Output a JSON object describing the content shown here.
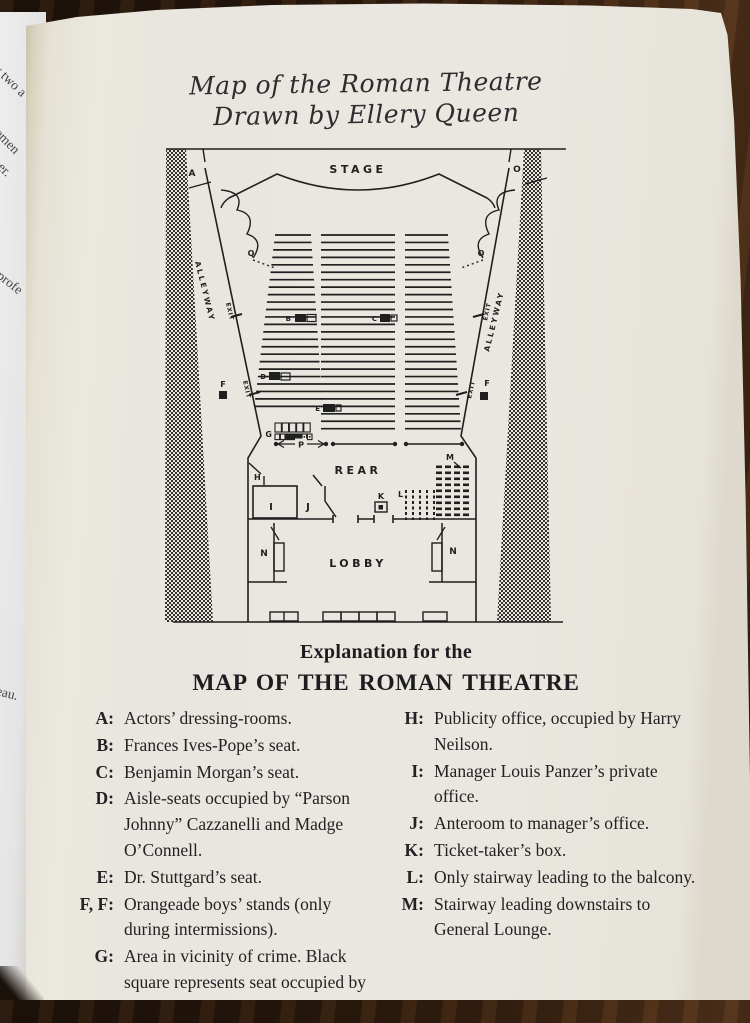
{
  "book_page": {
    "handwritten_title_line1": "Map of the Roman Theatre",
    "handwritten_title_line2": "Drawn by Ellery Queen",
    "explanation_heading": "Explanation for the",
    "explanation_title": "MAP OF THE ROMAN THEATRE"
  },
  "map": {
    "area_labels": {
      "stage": "STAGE",
      "rear": "REAR",
      "lobby": "LOBBY",
      "alleyway": "ALLEYWAY",
      "exit": "EXIT"
    },
    "point_labels": {
      "a": "A",
      "b": "B",
      "c": "C",
      "d": "D",
      "e": "E",
      "f": "F",
      "g": "G",
      "h": "H",
      "i": "I",
      "j": "J",
      "k": "K",
      "l": "L",
      "m": "M",
      "n": "N",
      "o": "O",
      "p": "P",
      "q": "Q"
    }
  },
  "legend": {
    "left": [
      {
        "key": "A:",
        "text": "Actors’ dressing-rooms."
      },
      {
        "key": "B:",
        "text": "Frances Ives-Pope’s seat."
      },
      {
        "key": "C:",
        "text": "Benjamin Morgan’s seat."
      },
      {
        "key": "D:",
        "text": "Aisle-seats occupied by “Parson Johnny” Cazzanelli and Madge O’Connell."
      },
      {
        "key": "E:",
        "text": "Dr. Stuttgard’s seat."
      },
      {
        "key": "F, F:",
        "text": "Orangeade boys’ stands (only during intermissions)."
      },
      {
        "key": "G:",
        "text": "Area in vicinity of crime. Black square represents seat occupied by Monte Field."
      }
    ],
    "right": [
      {
        "key": "H:",
        "text": "Publicity office, occupied by Harry Neilson."
      },
      {
        "key": "I:",
        "text": "Manager Louis Panzer’s private office."
      },
      {
        "key": "J:",
        "text": "Anteroom to manager’s office."
      },
      {
        "key": "K:",
        "text": "Ticket-taker’s box."
      },
      {
        "key": "L:",
        "text": "Only stairway leading to the balcony."
      },
      {
        "key": "M:",
        "text": "Stairway leading downstairs to General Lounge."
      }
    ]
  },
  "adjacent_page_fragments": [
    "or two a",
    "gentlemen",
    "iner.",
    "a profe",
    "reau."
  ],
  "colors": {
    "paper": "#e9e6df",
    "ink": "#1f1f1f",
    "wood": "#3c2513"
  }
}
